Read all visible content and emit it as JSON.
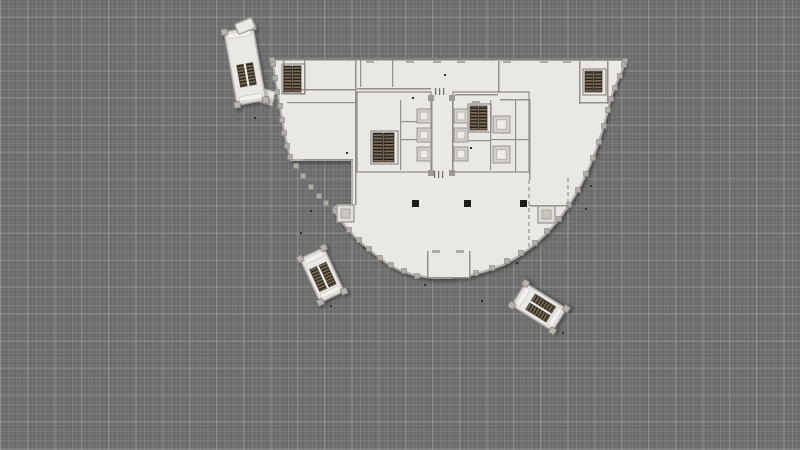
{
  "scene": {
    "description": "architectural floor plan of a fan-shaped office tower floor on gray plaid canvas",
    "colors": {
      "background": "#6c6b6b",
      "floor": "#eae8e4",
      "floor_bright": "#f3f1ee",
      "wall": "#94918c",
      "outline": "#b2afaa",
      "facade_column": "#b0ada7",
      "post": "#b7b4ae",
      "post_stroke": "#77746f",
      "elevator_outer": "#d2cfca",
      "elevator_inner": "#edebe7",
      "tread_light": "#7c6b51",
      "tread_dark": "#262019",
      "column_black": "#1b1a18",
      "speck": "#33312e",
      "tick": "#aeaba5",
      "planter_fill": "#dfddd8",
      "planter_inner": "#c9c6c0"
    }
  },
  "floorplan": {
    "outline_points": [
      [
        272,
        59
      ],
      [
        625,
        60
      ],
      [
        622,
        71
      ],
      [
        617,
        82
      ],
      [
        611,
        97
      ],
      [
        607,
        114
      ],
      [
        602,
        132
      ],
      [
        596,
        150
      ],
      [
        589,
        168
      ],
      [
        581,
        185
      ],
      [
        571,
        202
      ],
      [
        560,
        218
      ],
      [
        548,
        232
      ],
      [
        534,
        245
      ],
      [
        519,
        256
      ],
      [
        503,
        265
      ],
      [
        486,
        271
      ],
      [
        468,
        276
      ],
      [
        450,
        278
      ],
      [
        432,
        278
      ],
      [
        414,
        275
      ],
      [
        399,
        270
      ],
      [
        388,
        264
      ],
      [
        377,
        256
      ],
      [
        366,
        247
      ],
      [
        356,
        238
      ],
      [
        346,
        227
      ],
      [
        338,
        217
      ],
      [
        333,
        209
      ],
      [
        338,
        205
      ],
      [
        352,
        205
      ],
      [
        352,
        160
      ],
      [
        291,
        160
      ],
      [
        288,
        149
      ],
      [
        285,
        135
      ],
      [
        282,
        119
      ],
      [
        279,
        101
      ],
      [
        276,
        83
      ],
      [
        274,
        70
      ]
    ],
    "facade_columns": [
      [
        625,
        61
      ],
      [
        624,
        65
      ],
      [
        620,
        76
      ],
      [
        615,
        88
      ],
      [
        611,
        99
      ],
      [
        608,
        110
      ],
      [
        604,
        126
      ],
      [
        599,
        142
      ],
      [
        593,
        158
      ],
      [
        586,
        174
      ],
      [
        578,
        190
      ],
      [
        569,
        205
      ],
      [
        559,
        219
      ],
      [
        547,
        231
      ],
      [
        535,
        243
      ],
      [
        521,
        253
      ],
      [
        507,
        261
      ],
      [
        492,
        268
      ],
      [
        476,
        273
      ],
      [
        417,
        276
      ],
      [
        404,
        271
      ],
      [
        391,
        265
      ],
      [
        380,
        258
      ],
      [
        369,
        249
      ],
      [
        359,
        240
      ],
      [
        349,
        230
      ],
      [
        341,
        220
      ],
      [
        335,
        211
      ],
      [
        296,
        166
      ],
      [
        303,
        176
      ],
      [
        311,
        187
      ],
      [
        319,
        196
      ],
      [
        326,
        203
      ],
      [
        272,
        60
      ],
      [
        273,
        64
      ],
      [
        275,
        78
      ],
      [
        277,
        92
      ],
      [
        280,
        106
      ],
      [
        282,
        120
      ],
      [
        284,
        133
      ],
      [
        287,
        146
      ],
      [
        290,
        157
      ]
    ],
    "top_wall": [
      272,
      58,
      354,
      2.5
    ],
    "walls": [
      [
        283,
        89,
        72,
        1.5
      ],
      [
        355,
        60,
        1.5,
        145
      ],
      [
        287,
        102,
        68,
        1.2
      ],
      [
        283,
        60,
        1.5,
        34
      ],
      [
        283,
        93,
        22,
        1.5
      ],
      [
        304,
        60,
        1.2,
        34
      ],
      [
        360,
        60,
        1.2,
        27
      ],
      [
        392,
        60,
        1.2,
        27
      ],
      [
        357,
        88,
        74,
        1.5
      ],
      [
        431,
        97,
        1.5,
        78
      ],
      [
        452,
        97,
        1.5,
        78
      ],
      [
        455,
        94,
        43,
        1.5
      ],
      [
        498,
        61,
        1.5,
        32
      ],
      [
        500,
        99,
        30,
        1.5
      ],
      [
        529,
        99,
        1.5,
        81
      ],
      [
        529,
        205,
        39,
        1.5
      ],
      [
        515,
        99,
        1.2,
        73
      ],
      [
        579,
        60,
        1.5,
        44
      ],
      [
        579,
        102,
        29,
        1.5
      ],
      [
        607,
        60,
        1.5,
        44
      ],
      [
        400,
        100,
        1.2,
        70
      ],
      [
        400,
        121,
        17,
        1.2
      ],
      [
        400,
        139,
        17,
        1.2
      ],
      [
        490,
        100,
        1.2,
        70
      ],
      [
        490,
        139,
        39,
        1.2
      ],
      [
        468,
        140,
        22,
        1.2
      ],
      [
        427,
        251,
        1.5,
        27
      ],
      [
        469,
        251,
        1.5,
        27
      ],
      [
        427,
        277,
        43,
        1.5
      ],
      [
        303,
        159,
        50,
        1.5
      ]
    ],
    "dashed_walls": [
      {
        "x": 529,
        "y1": 180,
        "y2": 250
      },
      {
        "x": 568,
        "y1": 178,
        "y2": 248
      }
    ],
    "room_boxes": [
      [
        357,
        92,
        74,
        80
      ],
      [
        453,
        92,
        76,
        80
      ],
      [
        282,
        64,
        23,
        30
      ],
      [
        583,
        69,
        23,
        26
      ],
      [
        371,
        131,
        27,
        33
      ],
      [
        468,
        104,
        23,
        28
      ]
    ],
    "vestibule_fill": [
      428,
      252,
      41,
      25
    ],
    "connector": [
      [
        256,
        86
      ],
      [
        275,
        92
      ],
      [
        272,
        106
      ],
      [
        252,
        100
      ]
    ],
    "stair_flights": [
      [
        284,
        66,
        8,
        26
      ],
      [
        293,
        66,
        8,
        26
      ],
      [
        585,
        71,
        8,
        21
      ],
      [
        594,
        71,
        8,
        21
      ],
      [
        373,
        133,
        10,
        29
      ],
      [
        384,
        133,
        10,
        29
      ],
      [
        470,
        106,
        8,
        24
      ],
      [
        479,
        106,
        8,
        24
      ]
    ],
    "elevators_small": [
      [
        417,
        109
      ],
      [
        417,
        128
      ],
      [
        417,
        147
      ],
      [
        454,
        109
      ],
      [
        454,
        128
      ],
      [
        454,
        147
      ]
    ],
    "elevator_small_size": 14,
    "elevators_large": [
      [
        493,
        116
      ],
      [
        493,
        146
      ]
    ],
    "elevator_large_size": 17,
    "corridor_caps": [
      [
        428,
        95
      ],
      [
        449,
        95
      ],
      [
        428,
        170
      ],
      [
        449,
        170
      ]
    ],
    "columns_black": [
      [
        412,
        200
      ],
      [
        464,
        200
      ],
      [
        520,
        200
      ]
    ],
    "planters": [
      [
        337,
        205
      ],
      [
        538,
        206
      ]
    ],
    "planter_size": 17,
    "door_ticks": [
      [
        366,
        60
      ],
      [
        406,
        60
      ],
      [
        433,
        60
      ],
      [
        457,
        60
      ],
      [
        503,
        60
      ],
      [
        540,
        60
      ],
      [
        563,
        60
      ],
      [
        432,
        250
      ],
      [
        456,
        250
      ],
      [
        472,
        101
      ]
    ],
    "corridor_marks": [
      [
        435,
        88
      ],
      [
        439,
        88
      ],
      [
        443,
        88
      ],
      [
        434,
        171
      ],
      [
        438,
        171
      ],
      [
        442,
        171
      ]
    ],
    "specks": [
      [
        412,
        97
      ],
      [
        444,
        74
      ],
      [
        470,
        147
      ],
      [
        346,
        152
      ],
      [
        300,
        232
      ],
      [
        363,
        247
      ],
      [
        481,
        300
      ],
      [
        562,
        332
      ],
      [
        585,
        208
      ],
      [
        254,
        117
      ],
      [
        330,
        305
      ],
      [
        424,
        284
      ],
      [
        516,
        262
      ],
      [
        590,
        185
      ],
      [
        310,
        210
      ]
    ],
    "pods": [
      {
        "name": "stair-tower-northwest",
        "cx": 245,
        "cy": 66,
        "rot": -10,
        "len": 74,
        "wid": 29,
        "fy": 9,
        "flen": 22,
        "fwid": 7
      },
      {
        "name": "escalator-southwest",
        "cx": 322,
        "cy": 275,
        "rot": -25,
        "len": 48,
        "wid": 26,
        "fy": 2,
        "flen": 24,
        "fwid": 8
      },
      {
        "name": "escalator-southeast",
        "cx": 539,
        "cy": 307,
        "rot": -58,
        "len": 48,
        "wid": 26,
        "fy": 2,
        "flen": 24,
        "fwid": 8
      }
    ],
    "caps": [
      {
        "name": "tower-canopy",
        "cx": 245,
        "cy": 26,
        "rot": -22,
        "w": 18,
        "h": 11
      }
    ]
  }
}
